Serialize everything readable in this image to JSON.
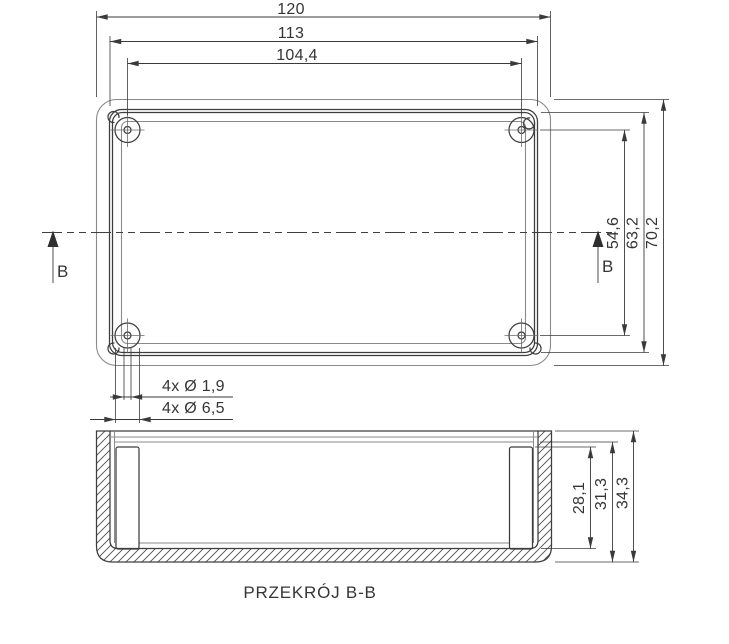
{
  "drawing": {
    "title": "Enclosure dimensional drawing",
    "section_label": "PRZEKRÓJ B-B",
    "section_marker": "B",
    "colors": {
      "background": "#ffffff",
      "object_line": "#8a8a8a",
      "main_line": "#3d3d3d",
      "dimension_line": "#3a3a3a",
      "text": "#353535"
    },
    "top_view": {
      "dims_horizontal": {
        "outer": "120",
        "lip": "113",
        "holes": "104,4"
      },
      "dims_vertical": {
        "holes": "54,6",
        "lip": "63,2",
        "outer": "70,2"
      },
      "hole_notes": {
        "small": "4x Ø 1,9",
        "large": "4x Ø 6,5"
      }
    },
    "section_view": {
      "dims_vertical": {
        "inner_depth": "28,1",
        "step_height": "31,3",
        "total_height": "34,3"
      }
    }
  }
}
